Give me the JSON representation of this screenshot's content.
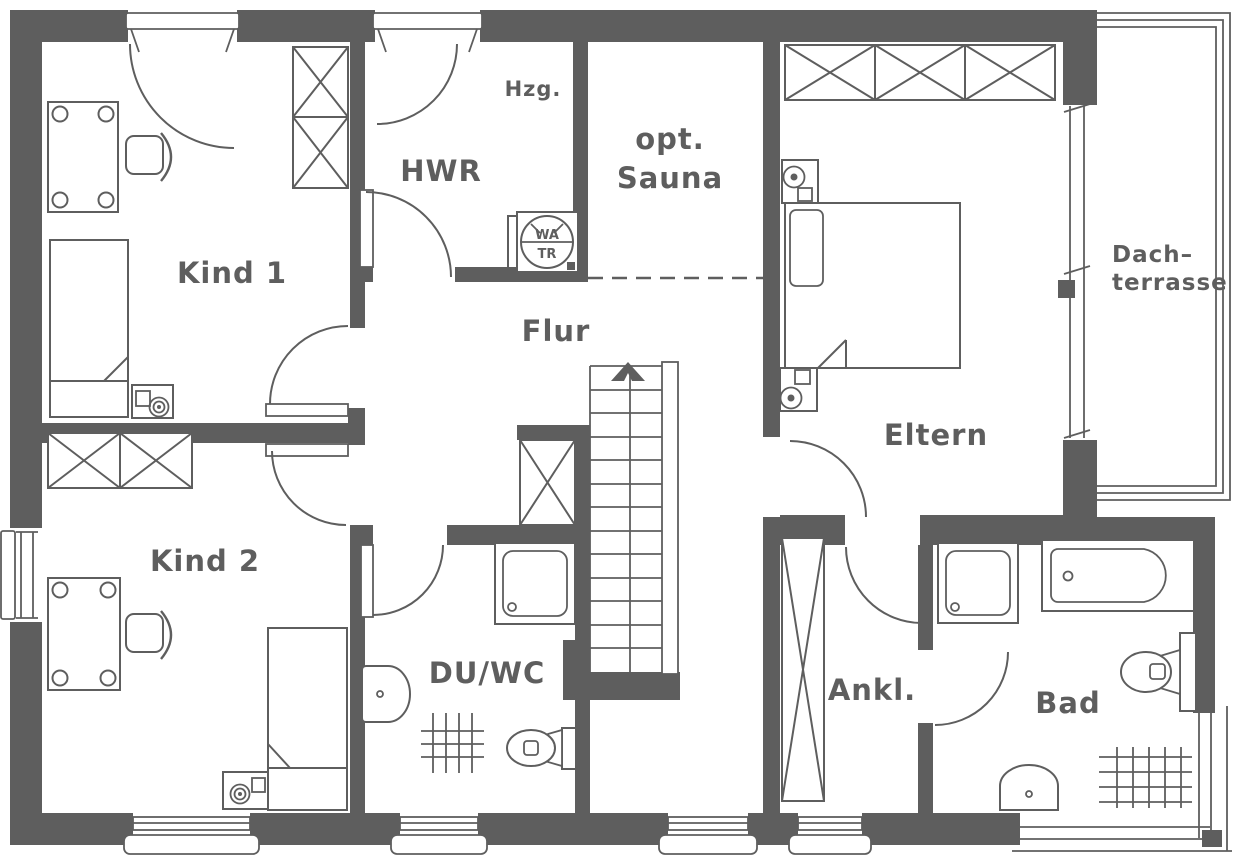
{
  "colors": {
    "ink": "#5e5e5e",
    "bg": "#ffffff"
  },
  "rooms": {
    "kind1": "Kind 1",
    "kind2": "Kind 2",
    "hwr": "HWR",
    "hzg": "Hzg.",
    "sauna_line1": "opt.",
    "sauna_line2": "Sauna",
    "flur": "Flur",
    "eltern": "Eltern",
    "terrace_line1": "Dach–",
    "terrace_line2": "terrasse",
    "duwc": "DU/WC",
    "ankl": "Ankl.",
    "bad": "Bad"
  },
  "appliances": {
    "washer": "WA",
    "dryer": "TR"
  }
}
